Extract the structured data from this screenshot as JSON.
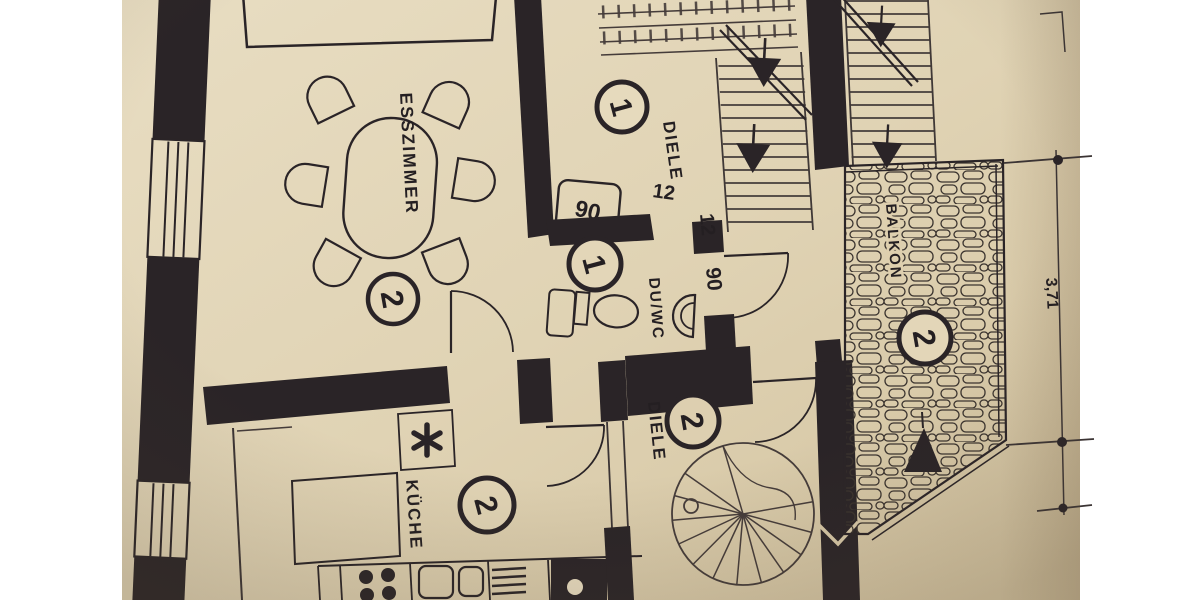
{
  "background": {
    "color": "#ffffff"
  },
  "paper": {
    "tone_light": "#e8ddc2",
    "tone_mid": "#ddd0b2",
    "tone_dark": "#d2c29f",
    "ink": "#2a2427"
  },
  "rooms": [
    {
      "id": "esszimmer",
      "label": "ESSZIMMER",
      "unit": "2"
    },
    {
      "id": "diele_upper",
      "label": "DIELE",
      "unit": "1"
    },
    {
      "id": "du_wc",
      "label": "DU/WC",
      "unit": "1"
    },
    {
      "id": "balkon",
      "label": "BALKON",
      "unit": "2"
    },
    {
      "id": "kueche",
      "label": "KÜCHE",
      "unit": "2"
    },
    {
      "id": "diele_lower",
      "label": "DIELE",
      "unit": "2"
    }
  ],
  "annotations": {
    "door_width_top": "90",
    "door_width_side": "90",
    "wall_thickness_a": "12",
    "wall_thickness_b": "12",
    "dimension_right": "3,71"
  },
  "symbols": [
    "dining-table",
    "chairs",
    "sideboard",
    "toilet",
    "washbasin",
    "shower-tray",
    "staircase-interior",
    "staircase-exterior",
    "spiral-staircase",
    "stone-paving",
    "stove-burners",
    "double-sink",
    "drainer",
    "appliance",
    "boiler-star",
    "direction-arrows",
    "balcony-triangle",
    "dimension-markers",
    "window-symbols",
    "door-arcs"
  ]
}
